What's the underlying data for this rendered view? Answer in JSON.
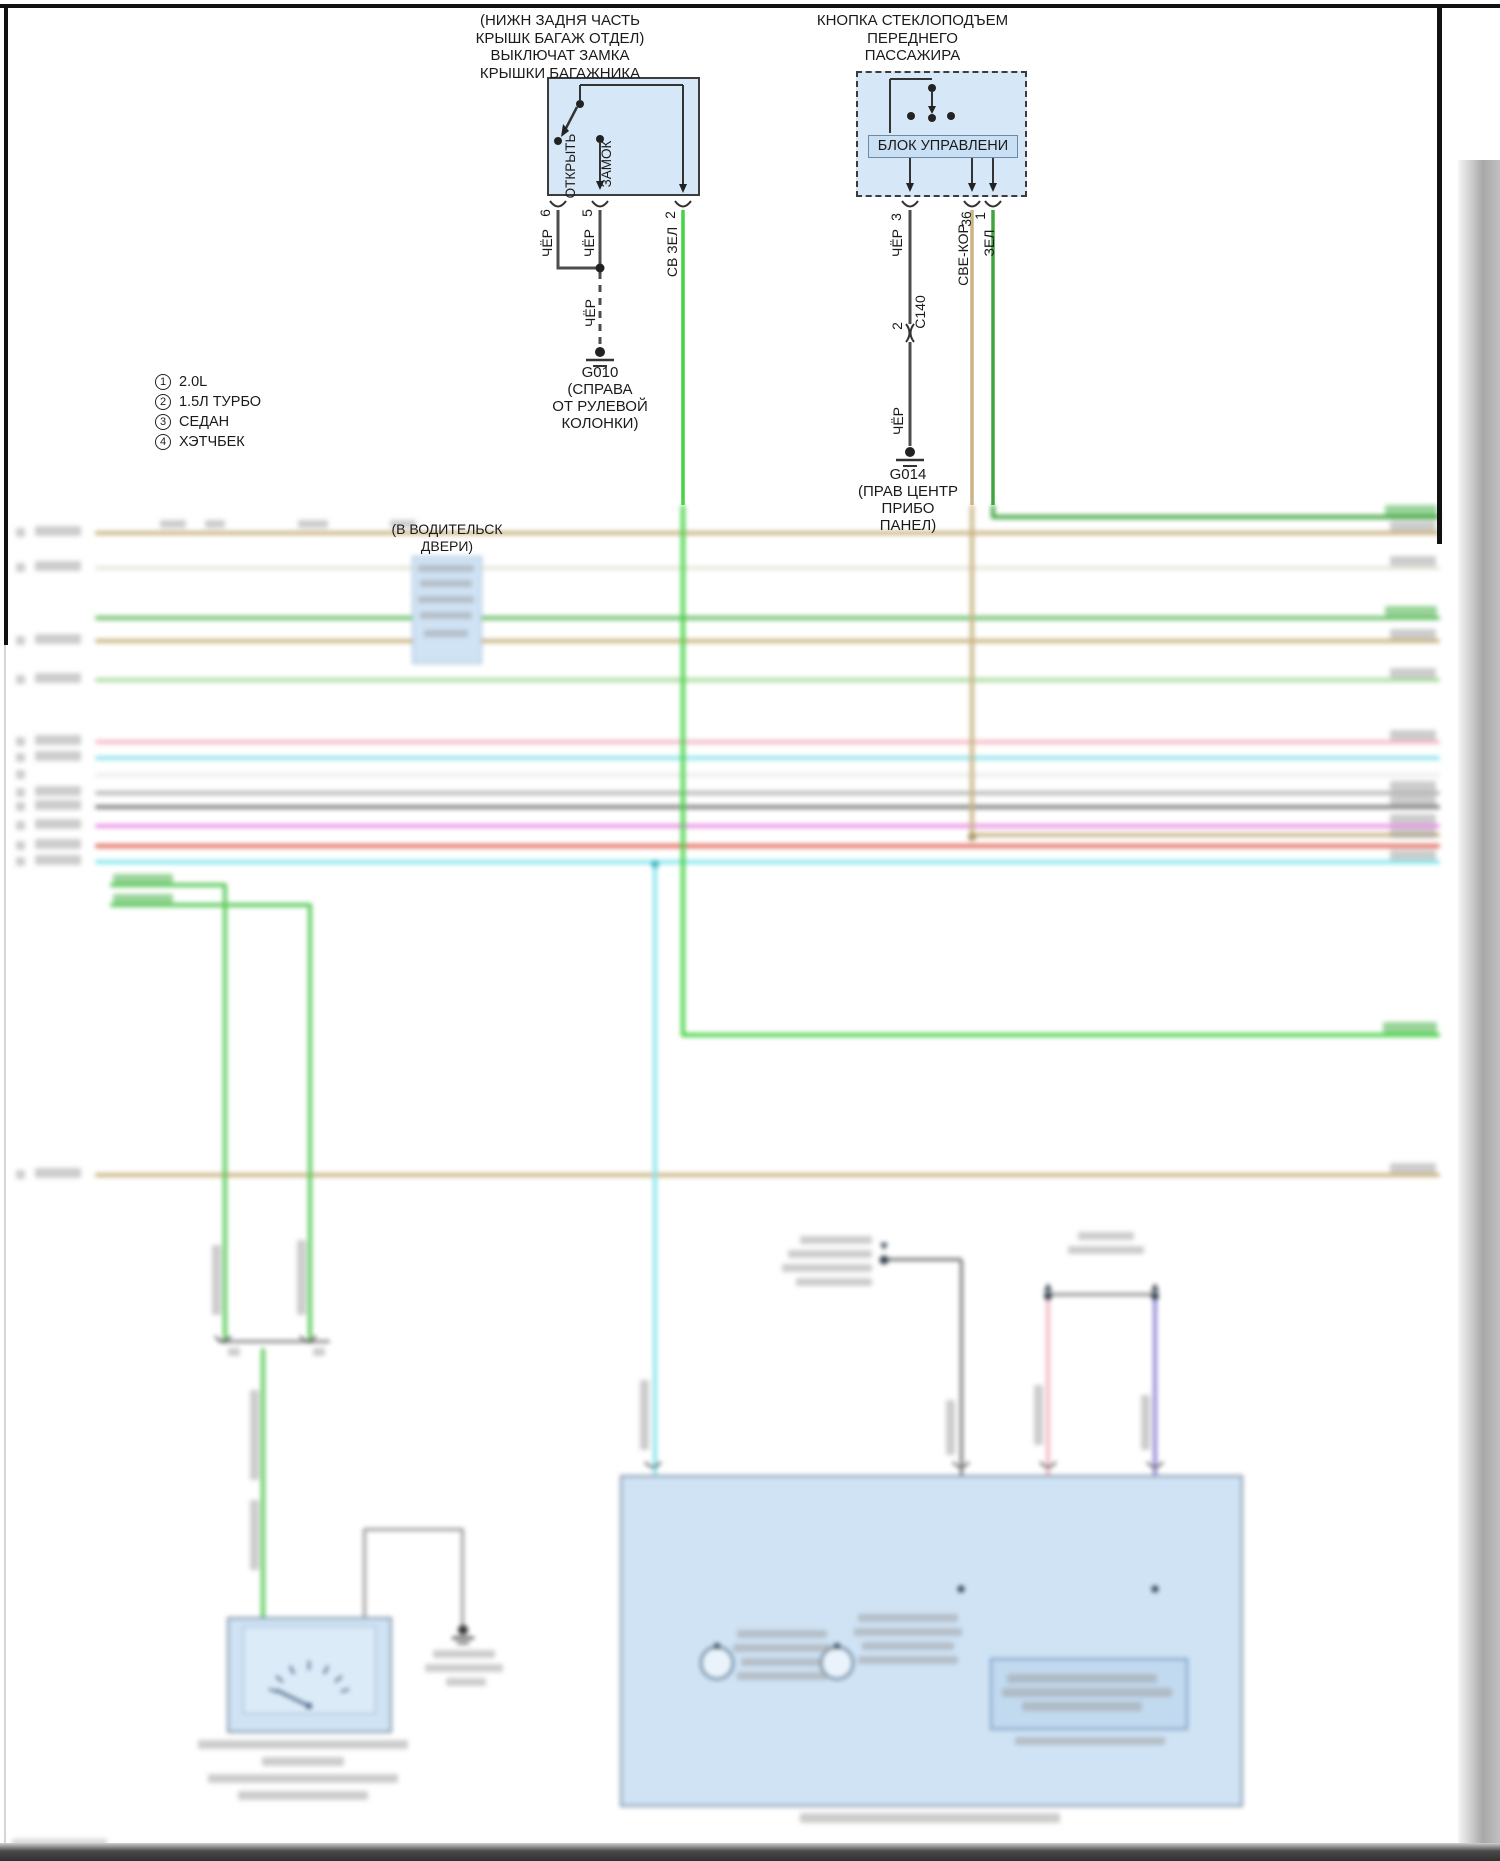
{
  "diagram": {
    "trunk_switch": {
      "title_lines": [
        "(НИЖН ЗАДНЯ ЧАСТЬ",
        "КРЫШК БАГАЖ ОТДЕЛ)",
        "ВЫКЛЮЧАТ ЗАМКА",
        "КРЫШКИ БАГАЖНИКА"
      ],
      "contact_open": "ОТКРЫТЬ",
      "contact_lock": "ЗАМОК",
      "pins": [
        "6",
        "5",
        "2"
      ],
      "wire_labels": {
        "pin6": "ЧЁР",
        "pin5": "ЧЁР",
        "pin2": "СВ ЗЕЛ",
        "ground": "ЧЁР"
      },
      "ground": {
        "id": "G010",
        "location_lines": [
          "(СПРАВА",
          "ОТ РУЛЕВОЙ",
          "КОЛОНКИ)"
        ]
      }
    },
    "window_switch": {
      "title_lines": [
        "КНОПКА СТЕКЛОПОДЪЕМ",
        "ПЕРЕДНЕГО",
        "ПАССАЖИРА"
      ],
      "control_block": "БЛОК УПРАВЛЕНИ",
      "pins": [
        "3",
        "36",
        "1"
      ],
      "wire_labels": {
        "pin3_upper": "ЧЁР",
        "pin36": "СВЕ-КОР",
        "pin1": "ЗЕЛ",
        "pin3_lower": "ЧЁР"
      },
      "connector": {
        "pin": "2",
        "id": "C140"
      },
      "ground": {
        "id": "G014",
        "location_lines": [
          "(ПРАВ ЦЕНТР",
          "ПРИБО",
          "ПАНЕЛ)"
        ]
      }
    },
    "legend": [
      {
        "num": "1",
        "label": "2.0L"
      },
      {
        "num": "2",
        "label": "1.5Л ТУРБО"
      },
      {
        "num": "3",
        "label": "СЕДАН"
      },
      {
        "num": "4",
        "label": "ХЭТЧБЕК"
      }
    ],
    "driver_door_note_lines": [
      "(В ВОДИТЕЛЬСК",
      "ДВЕРИ)"
    ],
    "colors": {
      "component_fill": "#d6e8f7",
      "wire_black": "#4d4d4d",
      "wire_light_green": "#44d444",
      "wire_green": "#3fa53f",
      "wire_tan": "#c9b483",
      "wire_cyan": "#8ae4ec",
      "wire_pink": "#f3bac5",
      "wire_magenta": "#ea93e5",
      "wire_red": "#e26b5c",
      "wire_purple": "#9189d9",
      "wire_gray": "#b7b7b7"
    }
  }
}
